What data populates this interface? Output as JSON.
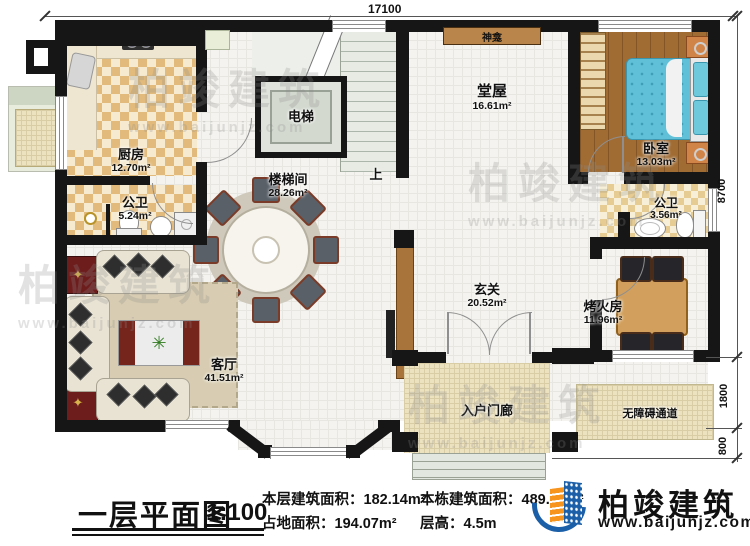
{
  "plan_title": {
    "title": "一层平面图",
    "scale": "1:100"
  },
  "stats": {
    "floor_area_label": "本层建筑面积：",
    "floor_area_value": "182.14m²",
    "footprint_label": "占地面积：",
    "footprint_value": "194.07m²",
    "total_area_label": "本栋建筑面积：",
    "total_area_value": "489.99m²",
    "height_label": "层高：",
    "height_value": "4.5m"
  },
  "dimensions": {
    "width_top": "17100",
    "depth_main": "8700",
    "depth_ramp": "1800",
    "depth_steps": "800"
  },
  "rooms": {
    "kitchen": {
      "name": "厨房",
      "area": "12.70m²"
    },
    "bath1": {
      "name": "公卫",
      "area": "5.24m²"
    },
    "elevator": {
      "name": "电梯"
    },
    "stairhall": {
      "name": "楼梯间",
      "area": "28.26m²"
    },
    "hall": {
      "name": "堂屋",
      "area": "16.61m²"
    },
    "shrine": {
      "name": "神龛"
    },
    "bedroom": {
      "name": "卧室",
      "area": "13.03m²"
    },
    "bath2": {
      "name": "公卫",
      "area": "3.56m²"
    },
    "foyer": {
      "name": "玄关",
      "area": "20.52m²"
    },
    "fireroom": {
      "name": "烤火房",
      "area": "11.96m²"
    },
    "living": {
      "name": "客厅",
      "area": "41.51m²"
    },
    "porch": {
      "name": "入户门廊"
    },
    "ramp": {
      "name": "无障碍通道"
    }
  },
  "annotations": {
    "stairs_up": "上"
  },
  "logo": {
    "name": "柏竣建筑",
    "url": "www.baijunjz.com"
  },
  "watermark": {
    "name": "柏竣建筑",
    "url": "www.baijunjz.com"
  },
  "colors": {
    "wall": "#161616",
    "checker": "#e2bb7c",
    "wood_floor": "#a06c34",
    "bed": "#5fc0d8",
    "shrine_bar": "#b9854a",
    "logo_blue": "#1b5fa8",
    "logo_orange": "#f7941d"
  }
}
